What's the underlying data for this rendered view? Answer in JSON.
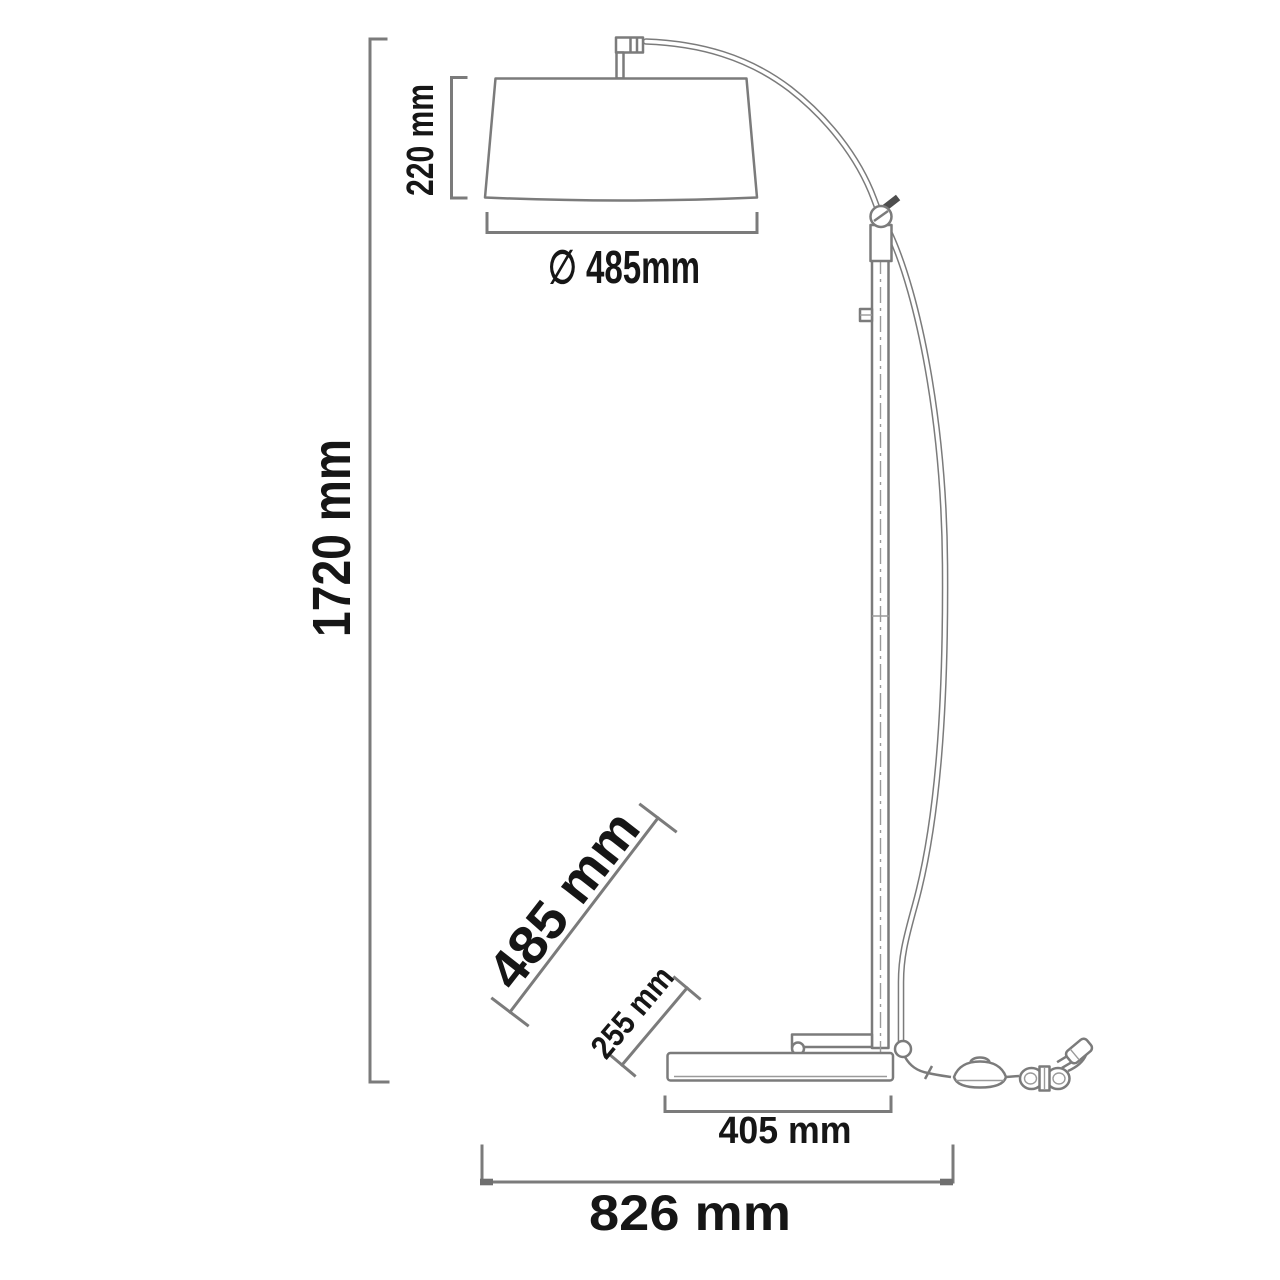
{
  "diagram": {
    "kind": "arc-floor-lamp-dimension-drawing",
    "background": "#ffffff",
    "line_color": "#7b7b7b",
    "text_color": "#161616"
  },
  "labels": {
    "height_overall": "1720 mm",
    "shade_height": "220 mm",
    "shade_diameter": "∅ 485mm",
    "arm_reach": "485 mm",
    "base_offset": "255 mm",
    "base_length": "405 mm",
    "depth_overall": "826 mm"
  }
}
